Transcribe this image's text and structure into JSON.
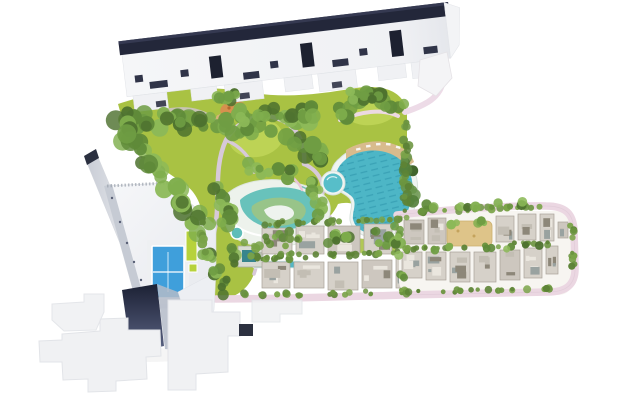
{
  "meta": {
    "title": "Aerial resort master-plan site map",
    "background": "#ffffff"
  },
  "palette": {
    "lawn": "#a9c243",
    "lawn_light": "#bdd355",
    "foliage_tree": [
      "#4e722f",
      "#5f8a39",
      "#6f9d43",
      "#7fae4d",
      "#8cb958"
    ],
    "foliage_hedge": [
      "#5d8336",
      "#6b943f",
      "#7aa348"
    ],
    "foliage_palm": [
      "#3f6329",
      "#54803a",
      "#68944a"
    ],
    "pool_teal": "#4db6c6",
    "pool_lane": "#2e95ab",
    "pool_rim": "#eff4f1",
    "splash_teal": "#68c2bb",
    "splash_green": "#98c489",
    "deck_tan": "#d8bb8d",
    "sand_courtyard": "#dec489",
    "road_pink": "#ebd7e2",
    "path_lavender": "#d7c9d9",
    "building_white": "#f3f4f6",
    "building_shadow": "#c6cbd4",
    "roof_dark": "#23273a",
    "navy_facade": "#232a44",
    "villa_roof": [
      "#d6d1c9",
      "#cdc7bf"
    ],
    "villa_detail": [
      "#8d8779",
      "#c3beb4",
      "#eae6de",
      "#99a2a0"
    ],
    "tennis_blue": "#3f9fdb",
    "sport_lime": "#b7d23c",
    "playground_orange": "#d6914e"
  },
  "features": {
    "apartment_row": {
      "name": "apartment-building-row"
    },
    "tower": {
      "name": "tower-with-diagonal-wing"
    },
    "tennis_court": {
      "name": "tennis-court"
    },
    "sport_court": {
      "name": "multi-sport-court"
    },
    "lagoon_pool": {
      "name": "lagoon-swimming-pool"
    },
    "round_pool": {
      "name": "round-plunge-pool"
    },
    "splash_area": {
      "name": "kids-splash-swirl-pool"
    },
    "canal": {
      "name": "water-canal"
    },
    "clubhouse": {
      "name": "clubhouse"
    },
    "playground": {
      "name": "playground"
    },
    "central_park": {
      "name": "central-landscaped-park"
    },
    "townhouse_rows": {
      "name": "townhouse-rows"
    },
    "villa_district": {
      "name": "villa-district-with-loop-road"
    },
    "courtyard": {
      "name": "sand-courtyard"
    },
    "footprints": {
      "name": "unbuilt-building-footprints"
    },
    "loop_road": {
      "name": "loop-road"
    },
    "south_road": {
      "name": "south-access-road"
    }
  },
  "foliage": {
    "clusters": [
      {
        "a": [
          128,
          118
        ],
        "b": [
          225,
          128
        ],
        "n": 26,
        "r": [
          5,
          9
        ],
        "s": 10,
        "p": "tree"
      },
      {
        "a": [
          225,
          128
        ],
        "b": [
          305,
          118
        ],
        "n": 22,
        "r": [
          5,
          9
        ],
        "s": 10,
        "p": "tree"
      },
      {
        "a": [
          305,
          118
        ],
        "b": [
          395,
          97
        ],
        "n": 24,
        "r": [
          5,
          9
        ],
        "s": 11,
        "p": "tree"
      },
      {
        "a": [
          120,
          122
        ],
        "b": [
          205,
          232
        ],
        "n": 34,
        "r": [
          6,
          10
        ],
        "s": 9,
        "p": "tree"
      },
      {
        "a": [
          232,
          112
        ],
        "b": [
          286,
          112
        ],
        "n": 10,
        "r": [
          4,
          7
        ],
        "s": 6,
        "p": "tree"
      },
      {
        "a": [
          290,
          140
        ],
        "b": [
          330,
          158
        ],
        "n": 14,
        "r": [
          5,
          9
        ],
        "s": 8,
        "p": "tree"
      },
      {
        "a": [
          216,
          190
        ],
        "b": [
          232,
          230
        ],
        "n": 12,
        "r": [
          5,
          8
        ],
        "s": 6,
        "p": "tree"
      },
      {
        "a": [
          250,
          166
        ],
        "b": [
          290,
          176
        ],
        "n": 10,
        "r": [
          4,
          7
        ],
        "s": 6,
        "p": "tree"
      },
      {
        "a": [
          312,
          176
        ],
        "b": [
          322,
          214
        ],
        "n": 10,
        "r": [
          4,
          7
        ],
        "s": 5,
        "p": "tree"
      },
      {
        "a": [
          408,
          160
        ],
        "b": [
          414,
          216
        ],
        "n": 12,
        "r": [
          4,
          7
        ],
        "s": 5,
        "p": "palm"
      },
      {
        "a": [
          330,
          238
        ],
        "b": [
          400,
          242
        ],
        "n": 14,
        "r": [
          4,
          6
        ],
        "s": 5,
        "p": "tree"
      },
      {
        "a": [
          407,
          116
        ],
        "b": [
          405,
          200
        ],
        "n": 20,
        "r": [
          3,
          5
        ],
        "s": 3,
        "p": "hedge"
      },
      {
        "a": [
          346,
          94
        ],
        "b": [
          400,
          104
        ],
        "n": 10,
        "r": [
          4,
          6
        ],
        "s": 5,
        "p": "tree"
      },
      {
        "a": [
          206,
          248
        ],
        "b": [
          228,
          292
        ],
        "n": 14,
        "r": [
          4,
          7
        ],
        "s": 5,
        "p": "tree"
      },
      {
        "a": [
          258,
          224
        ],
        "b": [
          408,
          218
        ],
        "n": 30,
        "r": [
          2,
          4
        ],
        "s": 2,
        "p": "hedge"
      },
      {
        "a": [
          258,
          258
        ],
        "b": [
          406,
          252
        ],
        "n": 30,
        "r": [
          2,
          4
        ],
        "s": 2,
        "p": "hedge"
      },
      {
        "a": [
          264,
          236
        ],
        "b": [
          400,
          228
        ],
        "n": 10,
        "r": [
          3,
          5
        ],
        "s": 4,
        "p": "tree"
      },
      {
        "a": [
          402,
          212
        ],
        "b": [
          548,
          206
        ],
        "n": 30,
        "r": [
          2,
          4
        ],
        "s": 2,
        "p": "hedge"
      },
      {
        "a": [
          240,
          295
        ],
        "b": [
          562,
          289
        ],
        "n": 46,
        "r": [
          2,
          4
        ],
        "s": 2,
        "p": "hedge"
      },
      {
        "a": [
          572,
          222
        ],
        "b": [
          573,
          284
        ],
        "n": 12,
        "r": [
          2,
          4
        ],
        "s": 2,
        "p": "hedge"
      },
      {
        "a": [
          404,
          249
        ],
        "b": [
          554,
          243
        ],
        "n": 28,
        "r": [
          2,
          3.5
        ],
        "s": 2,
        "p": "hedge"
      },
      {
        "a": [
          408,
          208
        ],
        "b": [
          540,
          203
        ],
        "n": 9,
        "r": [
          4,
          6
        ],
        "s": 3,
        "p": "tree"
      },
      {
        "a": [
          430,
          248
        ],
        "b": [
          560,
          246
        ],
        "n": 8,
        "r": [
          3,
          5
        ],
        "s": 3,
        "p": "tree"
      },
      {
        "a": [
          444,
          222
        ],
        "b": [
          496,
          220
        ],
        "n": 6,
        "r": [
          3,
          5
        ],
        "s": 3,
        "p": "tree"
      },
      {
        "a": [
          214,
          100
        ],
        "b": [
          246,
          96
        ],
        "n": 8,
        "r": [
          4,
          7
        ],
        "s": 5,
        "p": "tree"
      },
      {
        "a": [
          248,
          258
        ],
        "b": [
          306,
          256
        ],
        "n": 8,
        "r": [
          2.5,
          4
        ],
        "s": 3,
        "p": "hedge"
      },
      {
        "a": [
          232,
          244
        ],
        "b": [
          236,
          268
        ],
        "n": 6,
        "r": [
          4,
          6
        ],
        "s": 3,
        "p": "tree"
      },
      {
        "a": [
          396,
          230
        ],
        "b": [
          404,
          286
        ],
        "n": 8,
        "r": [
          3,
          5
        ],
        "s": 4,
        "p": "tree"
      },
      {
        "a": [
          246,
          246
        ],
        "b": [
          300,
          242
        ],
        "n": 10,
        "r": [
          3,
          5
        ],
        "s": 4,
        "p": "hedge"
      },
      {
        "a": [
          200,
          222
        ],
        "b": [
          204,
          250
        ],
        "n": 6,
        "r": [
          3,
          5
        ],
        "s": 3,
        "p": "hedge"
      }
    ]
  },
  "blocks": {
    "townhouses": [
      {
        "x": 262,
        "y": 228,
        "w": 30,
        "h": 26
      },
      {
        "x": 296,
        "y": 226,
        "w": 28,
        "h": 28
      },
      {
        "x": 328,
        "y": 226,
        "w": 32,
        "h": 28
      },
      {
        "x": 364,
        "y": 224,
        "w": 28,
        "h": 30
      },
      {
        "x": 396,
        "y": 222,
        "w": 12,
        "h": 30
      },
      {
        "x": 262,
        "y": 262,
        "w": 28,
        "h": 26
      },
      {
        "x": 294,
        "y": 262,
        "w": 30,
        "h": 26
      },
      {
        "x": 328,
        "y": 262,
        "w": 30,
        "h": 28
      },
      {
        "x": 362,
        "y": 260,
        "w": 30,
        "h": 28
      },
      {
        "x": 396,
        "y": 258,
        "w": 12,
        "h": 30
      }
    ],
    "villas": [
      {
        "x": 404,
        "y": 220,
        "w": 20,
        "h": 24
      },
      {
        "x": 428,
        "y": 218,
        "w": 18,
        "h": 26
      },
      {
        "x": 496,
        "y": 216,
        "w": 18,
        "h": 26
      },
      {
        "x": 518,
        "y": 214,
        "w": 18,
        "h": 26
      },
      {
        "x": 540,
        "y": 214,
        "w": 14,
        "h": 27
      },
      {
        "x": 558,
        "y": 222,
        "w": 10,
        "h": 16
      },
      {
        "x": 402,
        "y": 252,
        "w": 20,
        "h": 26
      },
      {
        "x": 426,
        "y": 252,
        "w": 20,
        "h": 28
      },
      {
        "x": 450,
        "y": 252,
        "w": 20,
        "h": 30
      },
      {
        "x": 474,
        "y": 252,
        "w": 22,
        "h": 30
      },
      {
        "x": 500,
        "y": 250,
        "w": 20,
        "h": 30
      },
      {
        "x": 524,
        "y": 248,
        "w": 18,
        "h": 30
      },
      {
        "x": 546,
        "y": 246,
        "w": 12,
        "h": 28
      }
    ]
  }
}
